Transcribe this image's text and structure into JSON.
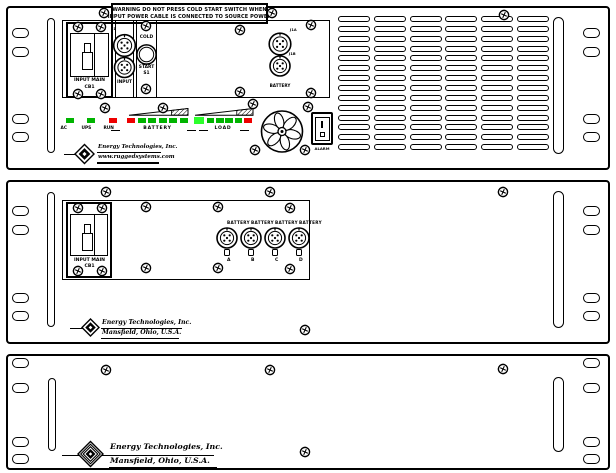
{
  "colors": {
    "line": "#000000",
    "green": "#00b400",
    "green_bright": "#2dff2d",
    "red": "#ee0000"
  },
  "panel1": {
    "warning": {
      "line1": "WARNING  DO NOT PRESS COLD START SWITCH WHEN",
      "line2": "INPUT POWER CABLE IS CONNECTED TO SOURCE POWER"
    },
    "breaker": {
      "title": "INPUT MAIN",
      "id": "CB1"
    },
    "input_section": {
      "jack_label": "J1",
      "caption": "INPUT"
    },
    "cold_start": {
      "word1": "COLD",
      "word2": "START",
      "id": "S1"
    },
    "battery_section": {
      "jack_label_top": "J1A",
      "jack_label_bottom": "J1B",
      "caption": "BATTERY"
    },
    "indicators": {
      "singles": [
        {
          "label": "AC",
          "color": "green"
        },
        {
          "label": "UPS",
          "color": "green"
        },
        {
          "label": "RUN",
          "color": "red"
        }
      ],
      "battery_bar": {
        "label": "BATTERY",
        "leds": [
          "red",
          "green",
          "green",
          "green",
          "green",
          "green"
        ]
      },
      "load_bar": {
        "label": "LOAD",
        "leds": [
          "green_bright",
          "green",
          "green",
          "green",
          "green",
          "red"
        ]
      }
    },
    "alarm": {
      "label": "ALARM",
      "on": "I",
      "off": "O"
    },
    "logo": {
      "line1": "Energy Technologies, Inc.",
      "line2": "www.ruggedsystems.com"
    }
  },
  "panel2": {
    "breaker": {
      "title": "INPUT MAIN",
      "id": "CB1"
    },
    "battery_ports": [
      {
        "title": "BATTERY",
        "letter": "A"
      },
      {
        "title": "BATTERY",
        "letter": "B"
      },
      {
        "title": "BATTERY",
        "letter": "C"
      },
      {
        "title": "BATTERY",
        "letter": "D"
      }
    ],
    "logo": {
      "line1": "Energy Technologies, Inc.",
      "line2": "Mansfield, Ohio, U.S.A."
    }
  },
  "panel3": {
    "logo": {
      "line1": "Energy Technologies, Inc.",
      "line2": "Mansfield, Ohio, U.S.A."
    }
  }
}
